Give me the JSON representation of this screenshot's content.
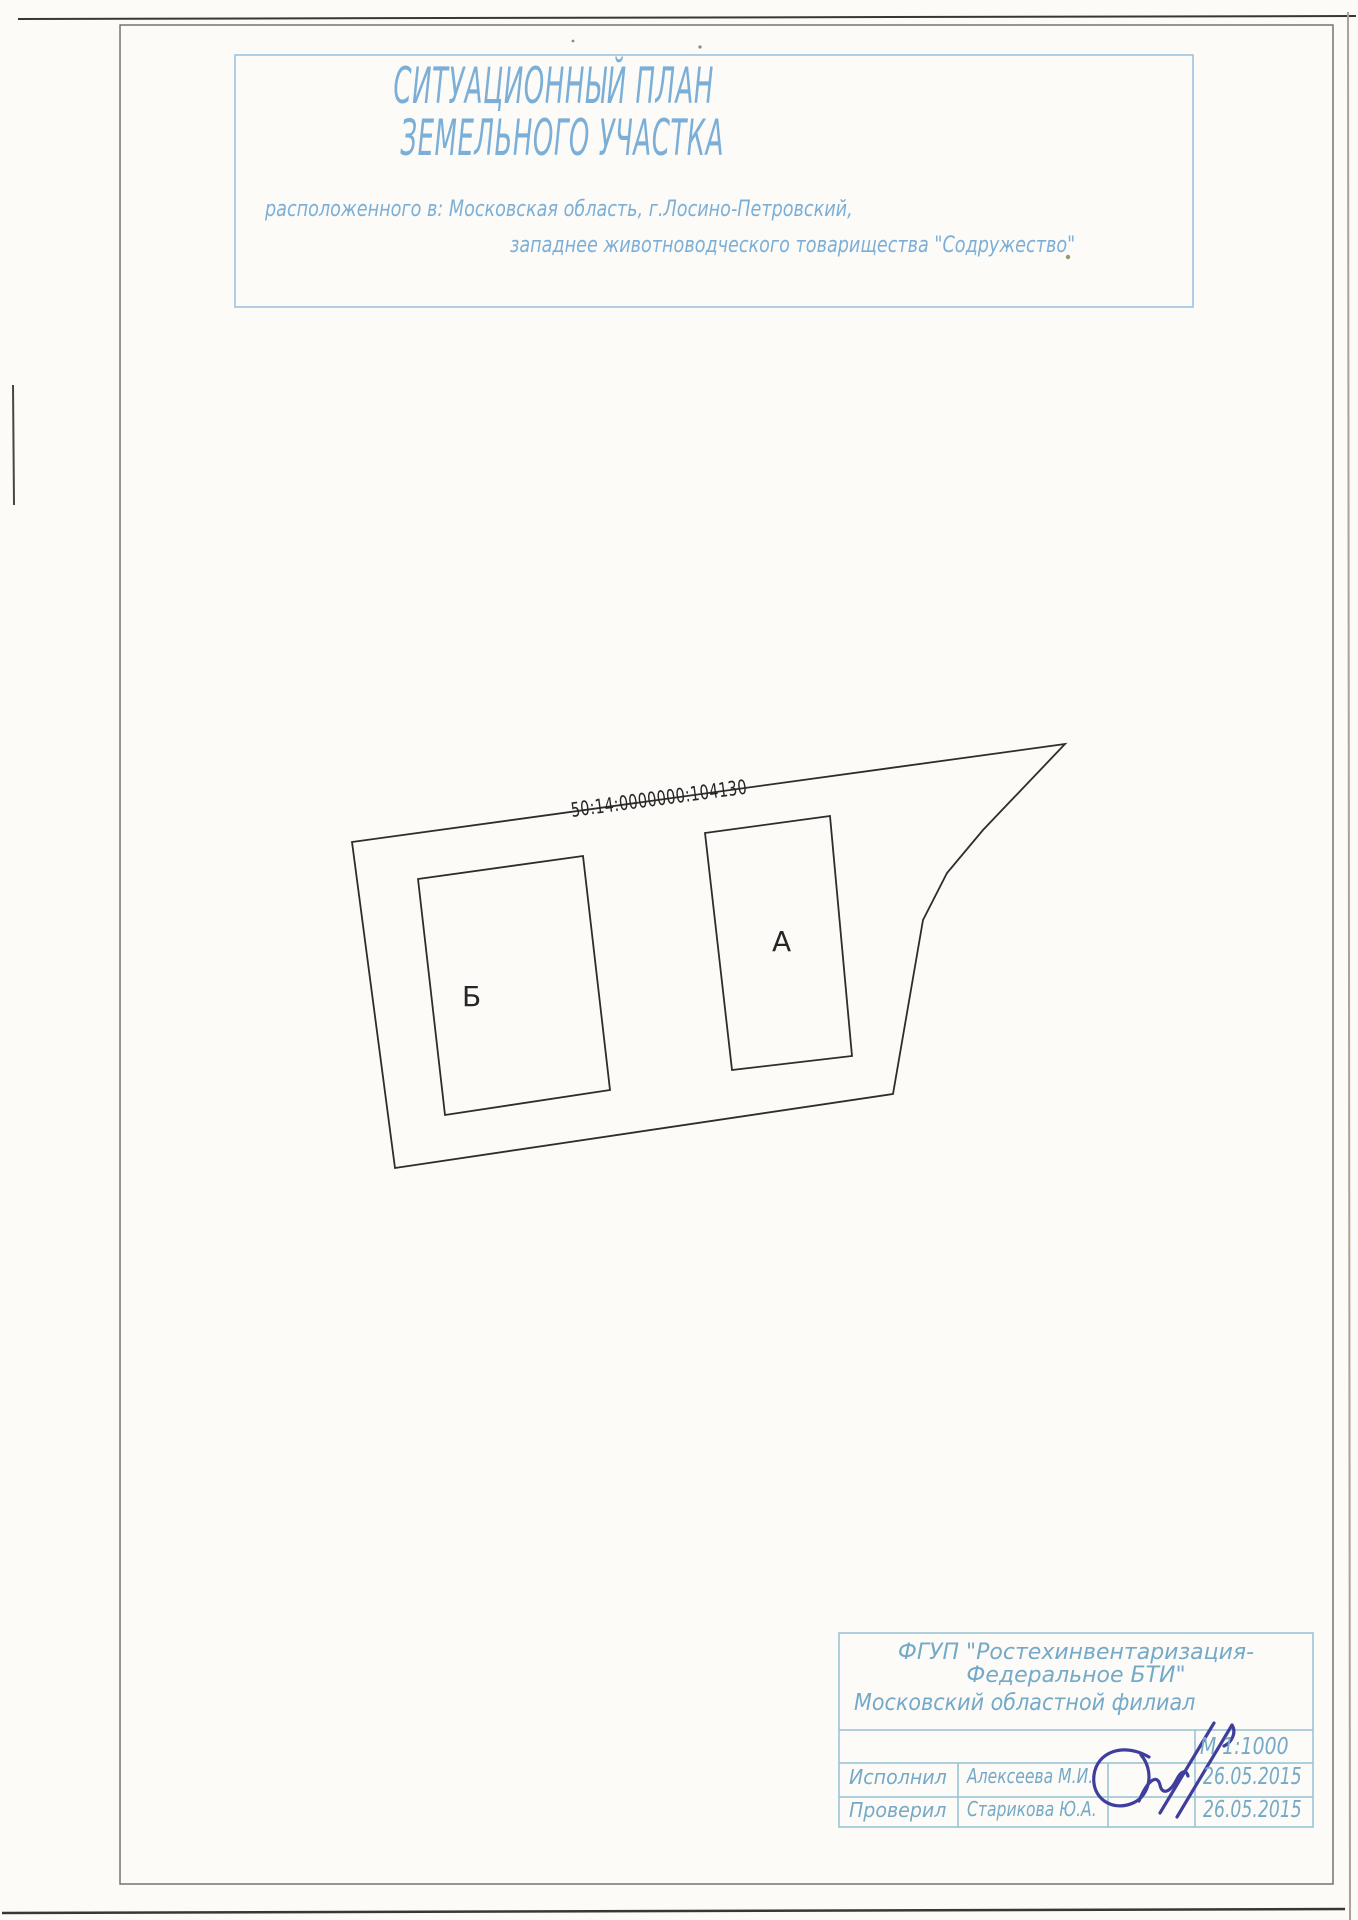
{
  "document": {
    "title_line1": "СИТУАЦИОННЫЙ ПЛАН",
    "title_line2": "ЗЕМЕЛЬНОГО УЧАСТКА",
    "location_line1": "расположенного в:  Московская область, г.Лосино-Петровский,",
    "location_line2": "западнее животноводческого товарищества \"Содружество\""
  },
  "plan": {
    "cadastral_number": "50:14:0000000:104130",
    "building_a_label": "А",
    "building_b_label": "Б"
  },
  "stamp": {
    "org_line1": "ФГУП \"Ростехинвентаризация-",
    "org_line2": "Федеральное БТИ\"",
    "branch": "Московский областной филиал",
    "scale": "М 1:1000",
    "rows": [
      {
        "role": "Исполнил",
        "name": "Алексеева М.И.",
        "date": "26.05.2015"
      },
      {
        "role": "Проверил",
        "name": "Старикова Ю.А.",
        "date": "26.05.2015"
      }
    ]
  },
  "colors": {
    "title_blue": "#7cafd7",
    "stamp_text_blue": "#74a9c7",
    "stamp_grid_blue": "#93c2d4",
    "signature_ink": "#3f3e9d",
    "drawing_line": "#2d2d2d",
    "paper": "#fcfbf8"
  }
}
